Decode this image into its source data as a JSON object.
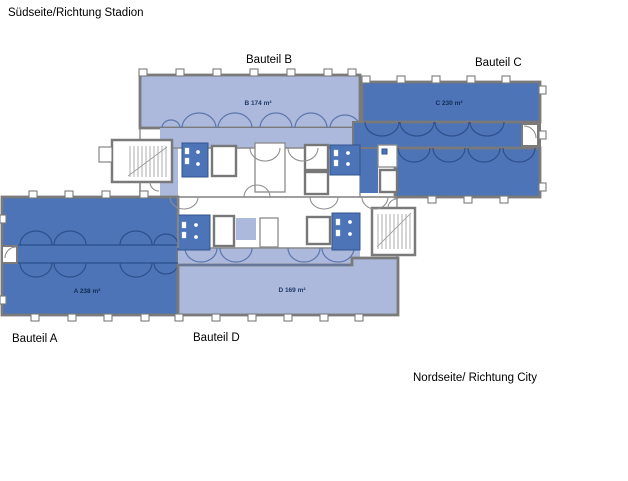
{
  "page": {
    "background": "#ffffff"
  },
  "orientation_labels": {
    "south": "Südseite/Richtung Stadion",
    "north": "Nordseite/ Richtung City"
  },
  "section_labels": {
    "a": "Bauteil A",
    "b": "Bauteil B",
    "c": "Bauteil C",
    "d": "Bauteil D"
  },
  "rooms": {
    "a": {
      "label": "A 238 m²",
      "area_m2": 238,
      "fill": "#4c74b6"
    },
    "b": {
      "label": "B 174 m²",
      "area_m2": 174,
      "fill": "#acb9dc"
    },
    "c": {
      "label": "C 230 m²",
      "area_m2": 230,
      "fill": "#4c74b6"
    },
    "d": {
      "label": "D 169 m²",
      "area_m2": 169,
      "fill": "#acb9dc"
    }
  },
  "legend_colors": {
    "room_light_blue": "#acb9dc",
    "room_dark_blue": "#4c74b6",
    "walls_gray": "#7a7a7a"
  }
}
